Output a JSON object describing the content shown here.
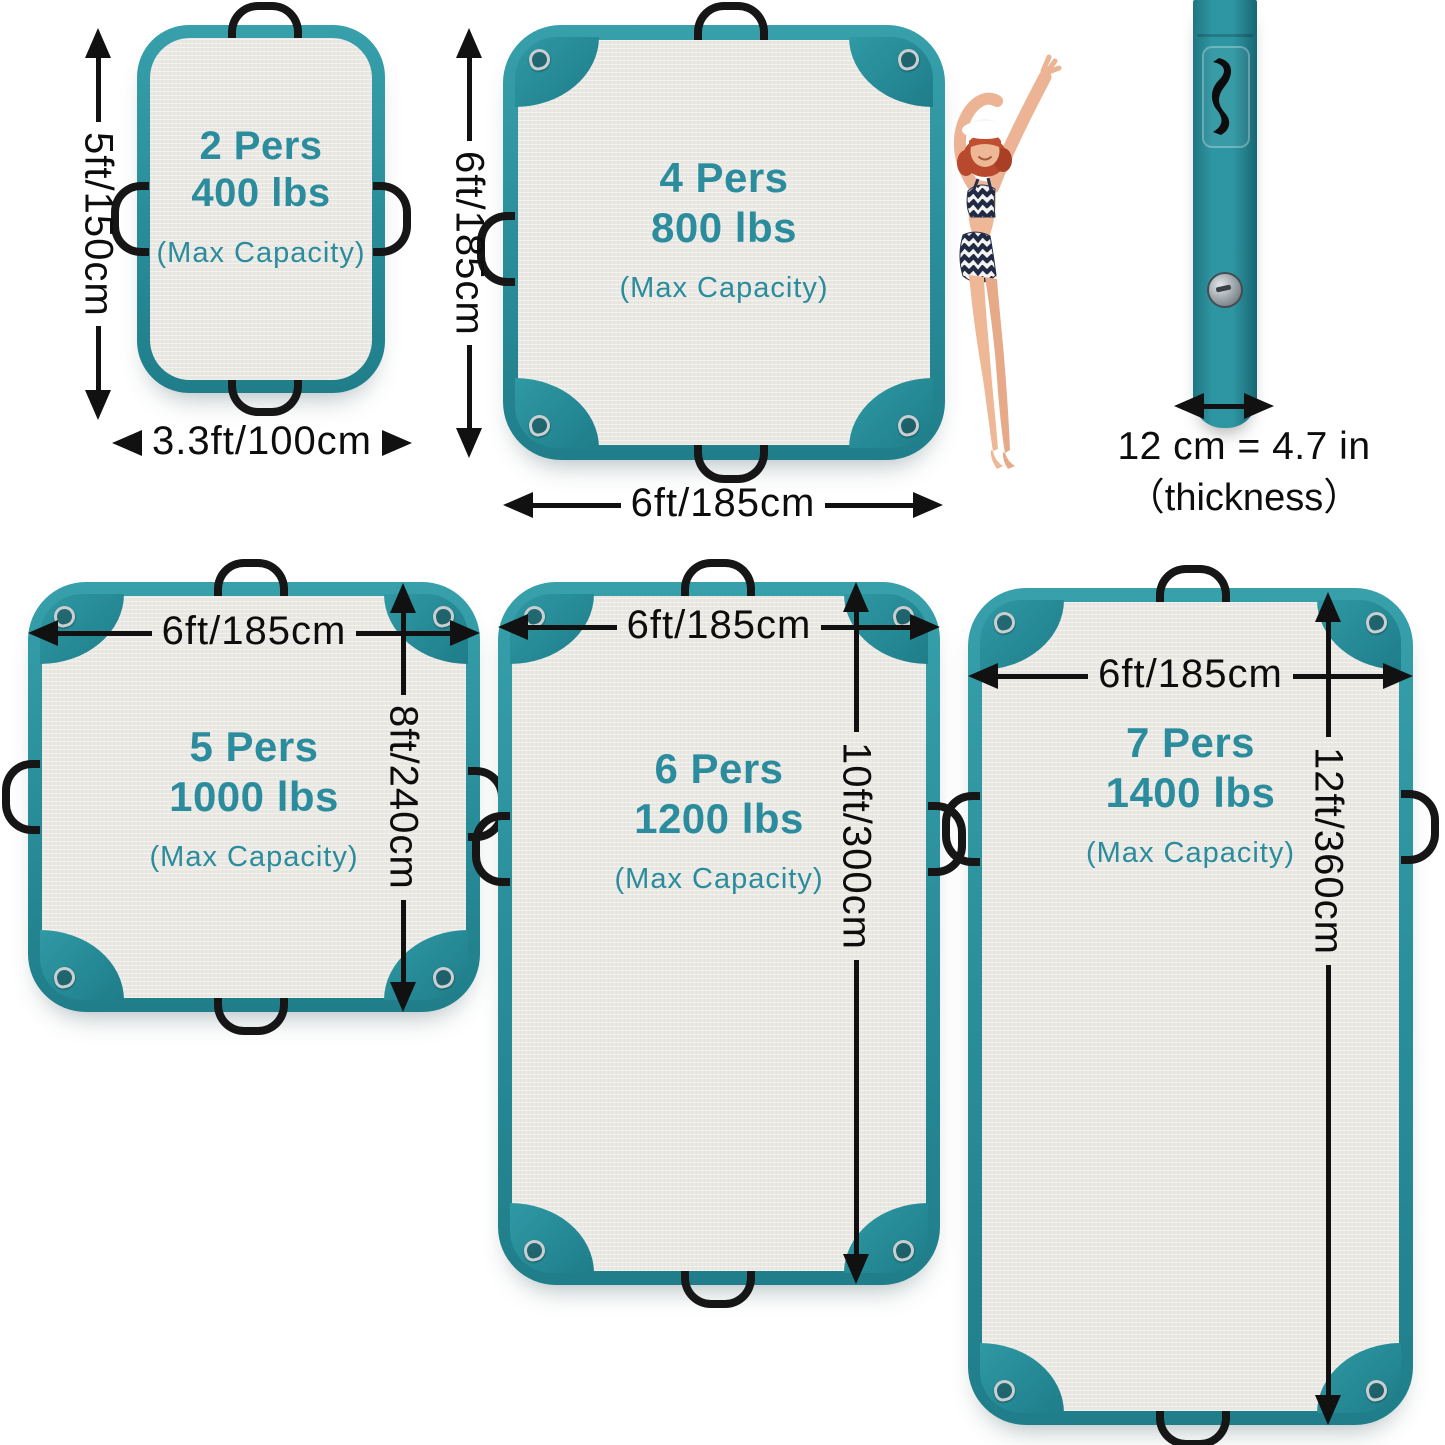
{
  "colors": {
    "teal_tube": "#2b909c",
    "teal_text": "#2a8c9c",
    "interior": "#eae8e3",
    "arrow_black": "#111111",
    "handle_black": "#161616"
  },
  "icons": {
    "handle": "black-arc-strap",
    "grommet": "metal-ring",
    "valve": "round-inflation-valve"
  },
  "platforms": [
    {
      "capacity": "2 Pers",
      "weight": "400 lbs",
      "note": "(Max Capacity)",
      "width": "3.3ft/100cm",
      "height": "5ft/150cm"
    },
    {
      "capacity": "4 Pers",
      "weight": "800 lbs",
      "note": "(Max Capacity)",
      "width": "6ft/185cm",
      "height": "6ft/185cm"
    },
    {
      "capacity": "5 Pers",
      "weight": "1000 lbs",
      "note": "(Max Capacity)",
      "width": "6ft/185cm",
      "height": "8ft/240cm"
    },
    {
      "capacity": "6 Pers",
      "weight": "1200 lbs",
      "note": "(Max Capacity)",
      "width": "6ft/185cm",
      "height": "10ft/300cm"
    },
    {
      "capacity": "7 Pers",
      "weight": "1400 lbs",
      "note": "(Max Capacity)",
      "width": "6ft/185cm",
      "height": "12ft/360cm"
    }
  ],
  "edge_view": {
    "thickness_value": "12 cm = 4.7 in",
    "thickness_note": "（thickness）"
  }
}
